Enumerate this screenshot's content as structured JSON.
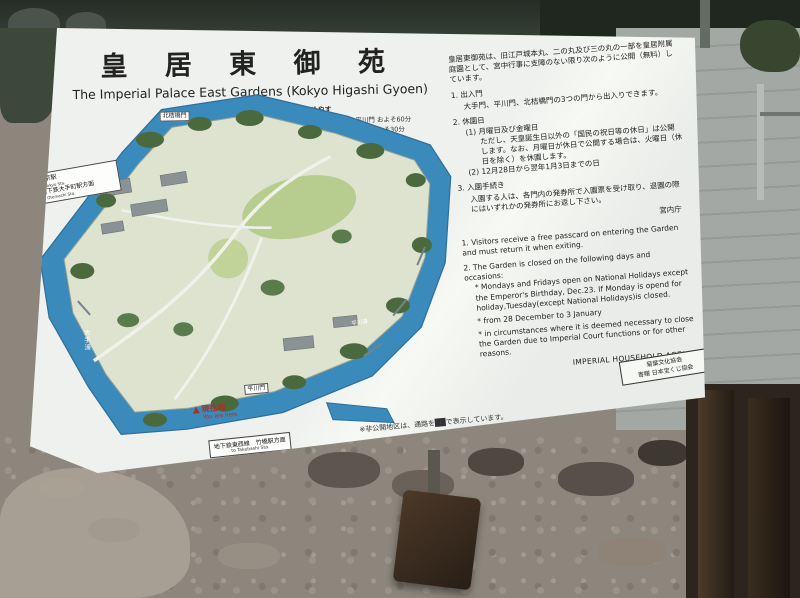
{
  "colors": {
    "sign_bg": "#f3f5f1",
    "moat_blue": "#3a8abc",
    "land": "#dde3cf",
    "lawn": "#b7cd90",
    "tree_green": "#4a6a3e",
    "red_marker": "#a93226",
    "pavement": "#a0a5a1",
    "gravel": "#8d867c",
    "dark_trees": "#252d26",
    "wood_post": "#3a2d20"
  },
  "icons": {
    "left_arrow": "◀",
    "down_arrow": "▼",
    "you_are_here_marker": "▲"
  },
  "sign": {
    "title_jp": "皇 居 東 御 苑",
    "title_en": "The Imperial Palace East Gardens (Kokyo Higashi Gyoen)",
    "legend": {
      "heading": "所要時間のめやす",
      "start": "平川門",
      "line1": "本丸、二の丸 ―― 平川門 およそ60分",
      "line2": "二の丸 ―――― 大手門 およそ30分",
      "line3": "本丸 ―――― 北桔橋門 およそ20分"
    },
    "map": {
      "label_kitahanebashimon": "北桔橋門",
      "label_otebori": "大手濠",
      "label_hirakawabori": "平川濠",
      "label_hirakawamon": "平川門",
      "tokyo_box_line1": "東京駅",
      "tokyo_box_line1_en": "to Tokyo Sta.",
      "tokyo_box_line2": "地下鉄大手町駅方面",
      "tokyo_box_line2_en": "to Otemachi Sta.",
      "you_are_here_jp": "現在地",
      "you_are_here_en": "You are here",
      "takebashi_jp": "地下鉄東西線　竹橋駅方面",
      "takebashi_en": "to Takebashi Sta.",
      "note": "※非公開地区は、通路を██で表示しています。"
    },
    "jp": {
      "intro": "皇居東御苑は、旧江戸城本丸、二の丸及び三の丸の一部を皇居附属庭園として、宮中行事に支障のない限り次のように公開（無料）しています。",
      "item1_title": "1. 出入門",
      "item1_body": "大手門、平川門、北桔橋門の3つの門から出入りできます。",
      "item2_title": "2. 休園日",
      "item2_sub1": "(1) 月曜日及び金曜日",
      "item2_sub1_body": "ただし、天皇誕生日以外の「国民の祝日等の休日」は公開します。なお、月曜日が休日で公開する場合は、火曜日（休日を除く）を休園します。",
      "item2_sub2": "(2) 12月28日から翌年1月3日までの日",
      "item3_title": "3. 入園手続き",
      "item3_body": "入園する人は、各門内の発券所で入園票を受け取り、退園の際にはいずれかの発券所にお返し下さい。",
      "agency": "宮内庁"
    },
    "en": {
      "item1": "1. Visitors receive a free passcard on entering the Garden and must return it when exiting.",
      "item2": "2. The Garden is closed on the following days and occasions:",
      "bullet1": "* Mondays and Fridays open on National Holidays except the Emperor's Birthday, Dec.23. If Monday is opend for holiday,Tuesday(except National Holidays)is closed.",
      "bullet2": "* from 28 December to 3 January",
      "bullet3": "* in circumstances where it is deemed necessary to close the Garden due to Imperial Court functions or for other reasons.",
      "agency": "IMPERIAL HOUSEHOLD AGENCY"
    },
    "stamp": {
      "line1": "菊葉文化協会",
      "line2": "寄贈 日本宝くじ協会"
    }
  }
}
